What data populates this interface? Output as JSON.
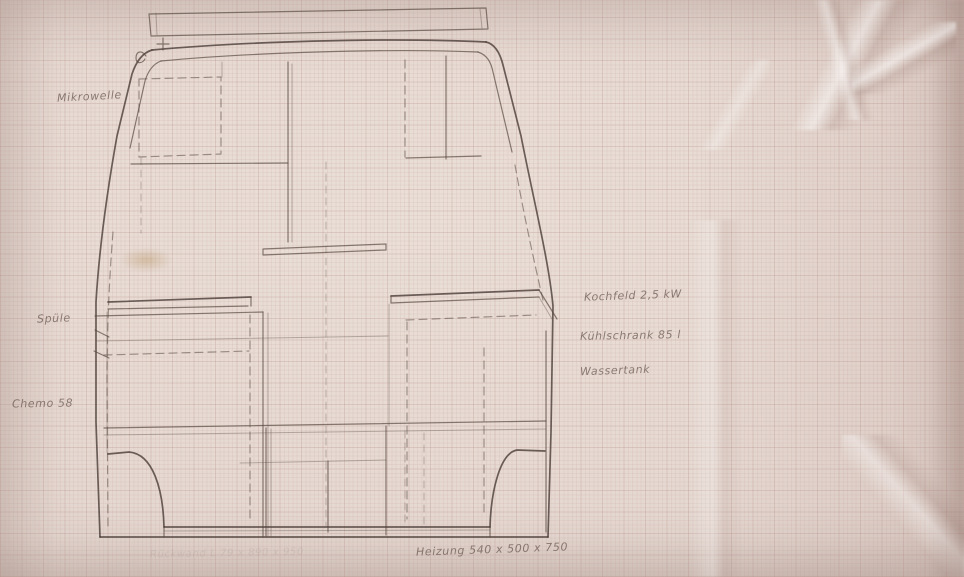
{
  "meta": {
    "description": "Hand-drawn pencil sketch on pinkish graph paper: rear view of a camper van body with interior furniture layout (cabinets, counters, wheel arches) and handwritten German annotations"
  },
  "paper": {
    "base_color": "#e5d8d1",
    "grid_color": "#c9b3ac",
    "pencil_color": "#5a4b42"
  },
  "annotations": {
    "mikrowelle": {
      "text": "Mikrowelle"
    },
    "spuele": {
      "text": "Spüle"
    },
    "chemo": {
      "text": "Chemo 58"
    },
    "kochfeld": {
      "text": "Kochfeld 2,5 kW"
    },
    "kuehlschrank": {
      "text": "Kühlschrank 85 l"
    },
    "wassertank": {
      "text": "Wassertank"
    },
    "heizung": {
      "text": "Heizung 540 x 500 x 750"
    },
    "aufbau_faint": {
      "text": "Rückwand L 79 x 890 x 950"
    }
  }
}
